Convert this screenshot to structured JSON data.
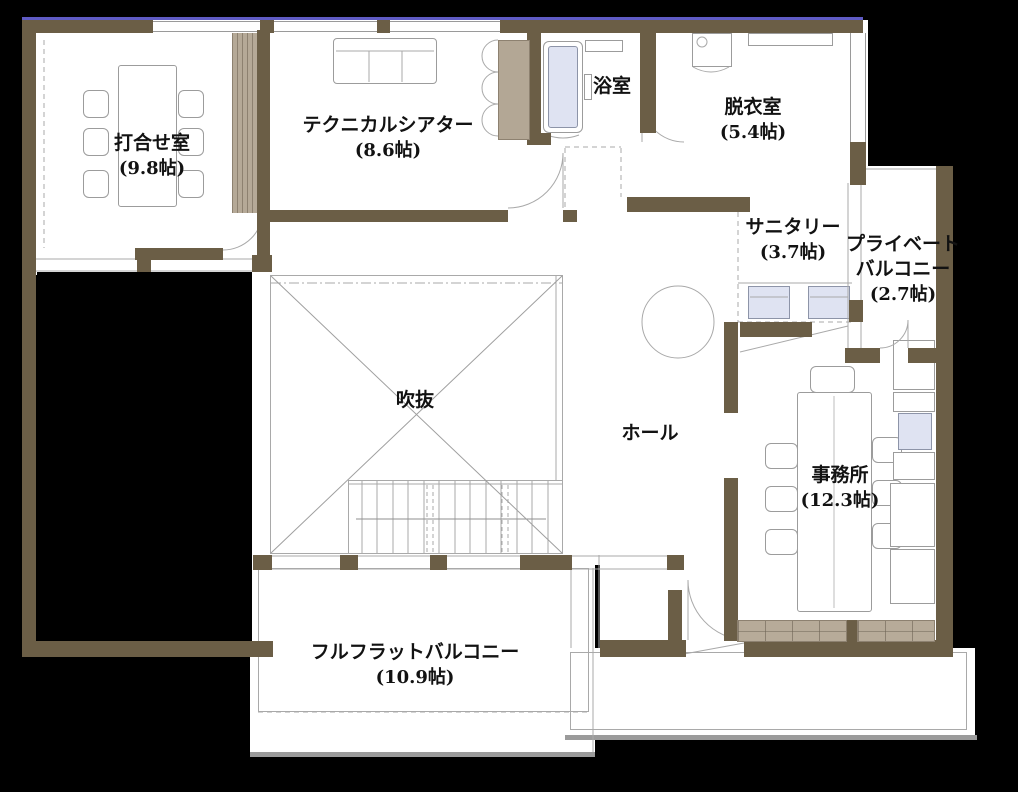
{
  "floorplan": {
    "type": "japanese-house-second-floor-plan",
    "rooms": [
      {
        "id": "meeting-room",
        "name": "打合せ室",
        "size": "(9.8帖)"
      },
      {
        "id": "technical-theater",
        "name": "テクニカルシアター",
        "size": "(8.6帖)"
      },
      {
        "id": "bathroom",
        "name": "浴室",
        "size": ""
      },
      {
        "id": "dressing-room",
        "name": "脱衣室",
        "size": "(5.4帖)"
      },
      {
        "id": "sanitary",
        "name": "サニタリー",
        "size": "(3.7帖)"
      },
      {
        "id": "private-balcony",
        "name_line1": "プライベート",
        "name_line2": "バルコニー",
        "size": "(2.7帖)"
      },
      {
        "id": "void-atrium",
        "name": "吹抜",
        "size": ""
      },
      {
        "id": "hall",
        "name": "ホール",
        "size": ""
      },
      {
        "id": "office",
        "name": "事務所",
        "size": "(12.3帖)"
      },
      {
        "id": "full-flat-balcony",
        "name": "フルフラットバルコニー",
        "size": "(10.9帖)"
      }
    ],
    "colors": {
      "wall": "#6b5e46",
      "accent_blue_edge": "#5f5bc4",
      "closet_tan": "#b3a795",
      "fixture_blue": "#dfe3f2",
      "line_gray": "#a9a9a9",
      "floor": "#ffffff",
      "background": "#000000"
    }
  }
}
